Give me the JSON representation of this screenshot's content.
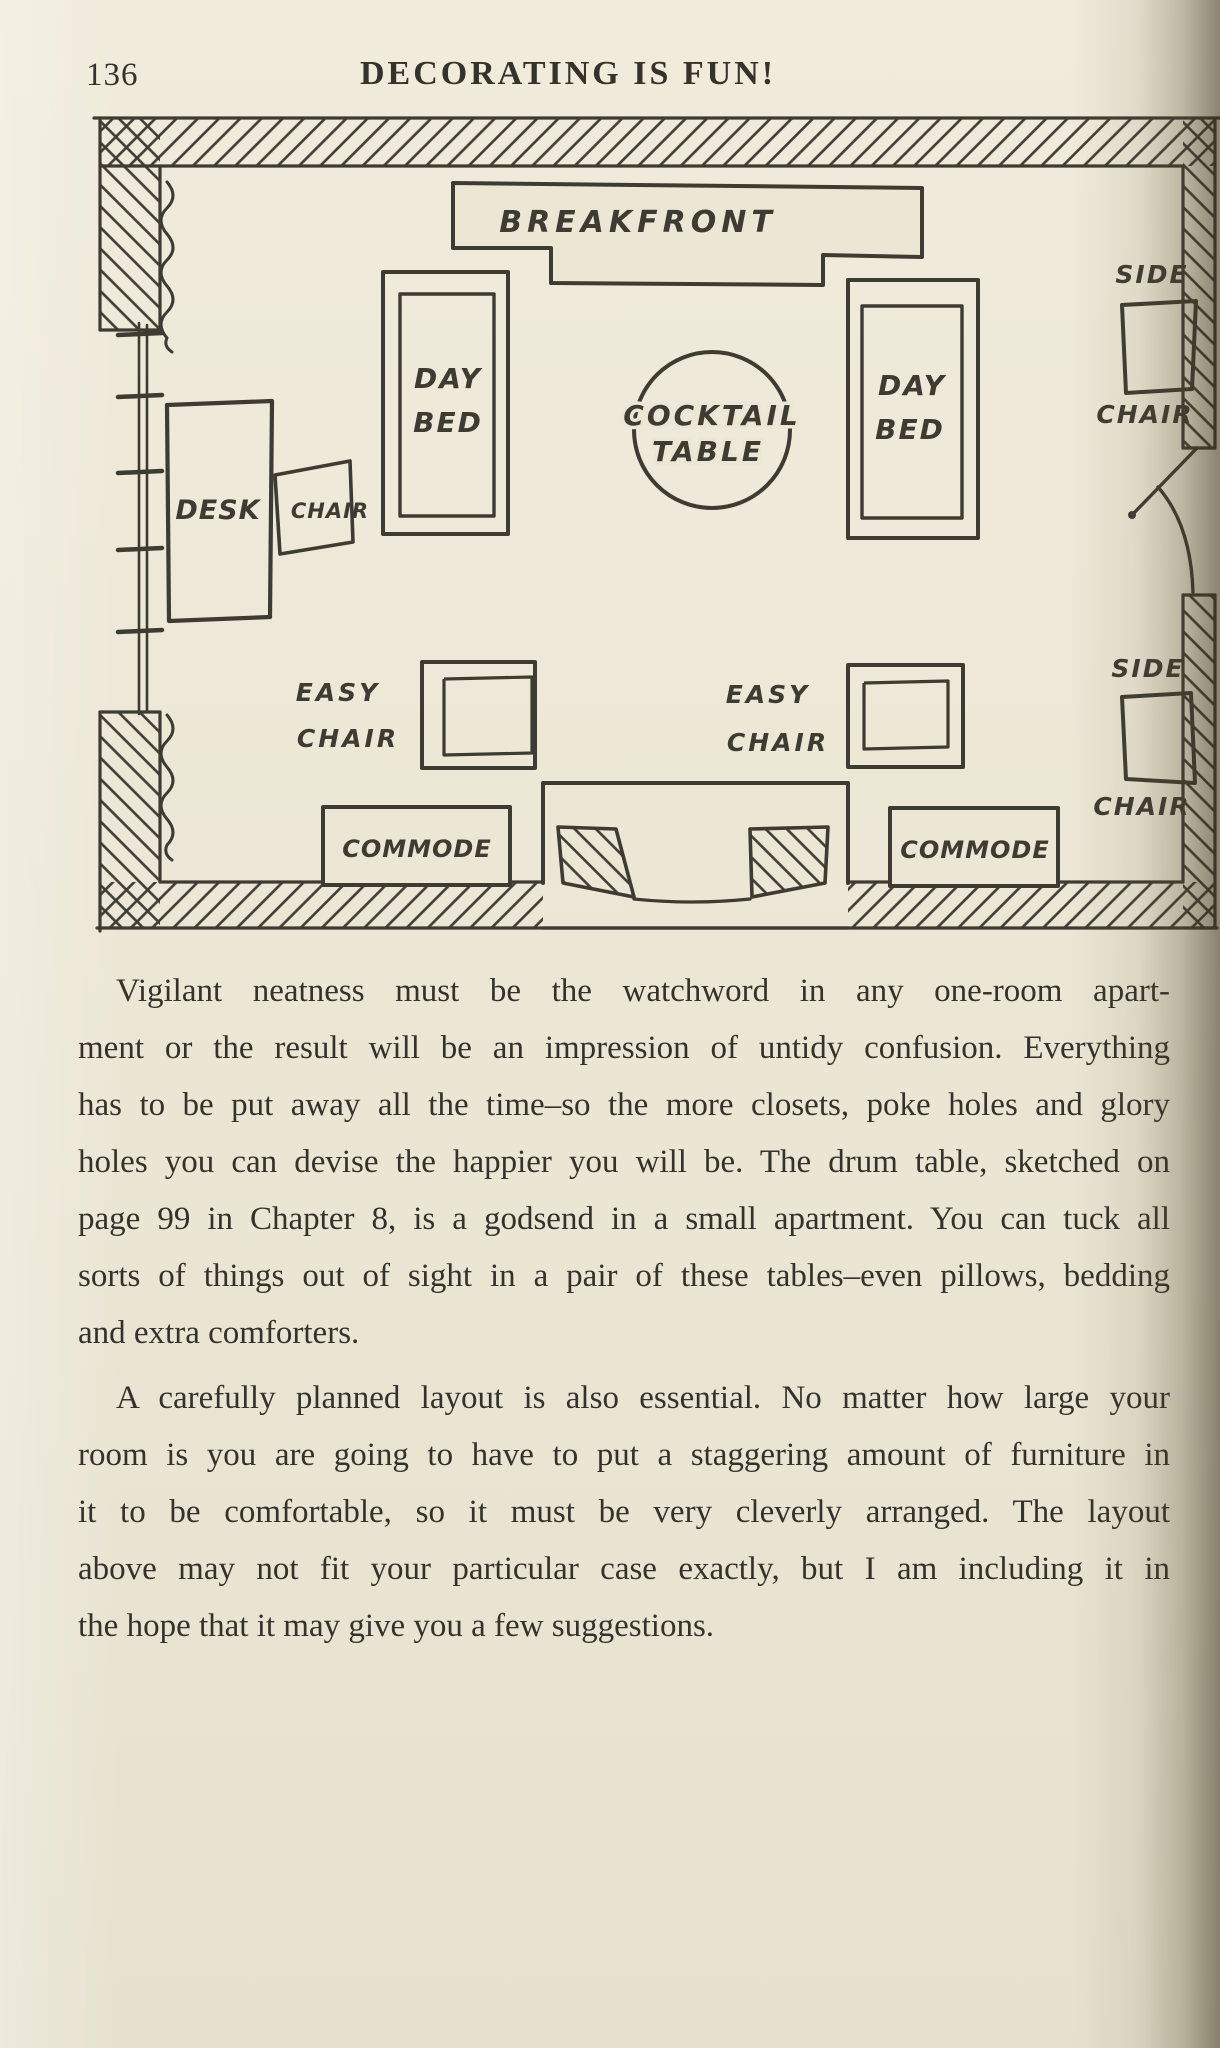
{
  "page": {
    "number": "136",
    "running_title": "DECORATING IS FUN!"
  },
  "floor_plan": {
    "breakfront": "BREAKFRONT",
    "day_bed_left": {
      "l1": "DAY",
      "l2": "BED"
    },
    "day_bed_right": {
      "l1": "DAY",
      "l2": "BED"
    },
    "cocktail_table": {
      "l1": "COCKTAIL",
      "l2": "TABLE"
    },
    "desk": "DESK",
    "desk_chair": "CHAIR",
    "side_chair_top": {
      "l1": "SIDE",
      "l2": "CHAIR"
    },
    "side_chair_bottom": {
      "l1": "SIDE",
      "l2": "CHAIR"
    },
    "easy_chair_left": {
      "l1": "EASY",
      "l2": "CHAIR"
    },
    "easy_chair_right": {
      "l1": "EASY",
      "l2": "CHAIR"
    },
    "commode_left": "COMMODE",
    "commode_right": "COMMODE"
  },
  "body": {
    "p1": {
      "lines": [
        "Vigilant neatness must be the watchword in any one-room apart-",
        "ment or the result will be an impression of untidy confusion. Everything",
        "has to be put away all the time–so the more closets, poke holes and glory",
        "holes you can devise the happier you will be. The drum table, sketched on",
        "page 99 in Chapter 8, is a godsend in a small apartment. You can tuck all",
        "sorts of things out of sight in a pair of these tables–even pillows, bedding",
        "and extra comforters."
      ]
    },
    "p2": {
      "lines": [
        "A carefully planned layout is also essential. No matter how large your",
        "room is you are going to have to put a staggering amount of furniture in",
        "it to be comfortable, so it must be very cleverly arranged. The layout",
        "above may not fit your particular case exactly, but I am including it in",
        "the hope that it may give you a few suggestions."
      ]
    }
  },
  "colors": {
    "paper": "#ece7d5",
    "ink": "#3e3b32",
    "gutter_shadow": "#55481a"
  }
}
